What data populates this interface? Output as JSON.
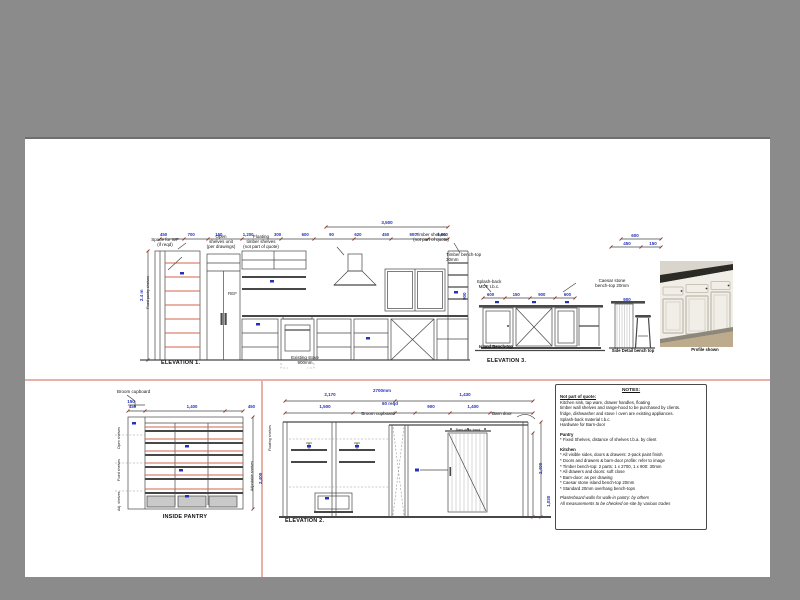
{
  "colors": {
    "background": "#8b8b8b",
    "paper": "#ffffff",
    "dim_blue": "#2633b8",
    "line_dark": "#474747",
    "shelf_red": "#d0664e",
    "divider_pink": "#e8b1a7"
  },
  "elevation1": {
    "title": "ELEVATION 1.",
    "overall_dim": "3,500",
    "top_dims": [
      "450",
      "700",
      "150",
      "1,200",
      "300",
      "600",
      "90",
      "620",
      "450",
      "900",
      "1,000"
    ],
    "left_height_dim": "2.4 m",
    "left_rotated_label": "Fixed pantry shelves",
    "right_height_dim": "900",
    "label_space_wf": "Space for WF\n(if reqd)",
    "label_open_shelves": "Open\nshelves unit\n(per drawings)",
    "label_floating_shelves": "Floating\ntimber shelves\n(not part of quote)",
    "label_timber_shelves": "Timber shelves\n(not part of quote)",
    "label_bench_top": "Timber bench-top\n30mm",
    "fridge_text": "REF",
    "label_stove": "Existing stove\n900mm"
  },
  "elevation3": {
    "title": "ELEVATION 3.",
    "label_splashback": "Splash-back\nMDF t.b.c.",
    "label_caesar": "Caesar stone\nbench-top 20mm",
    "dims": [
      "600",
      "150",
      "900",
      "600"
    ],
    "cab_left_text": "DW",
    "cab_right_text": "Bin",
    "label_island": "Island Bench-top",
    "label_side_detail": "Side Detail bench top",
    "stool_dim": "900"
  },
  "detail_dims": {
    "top": "600",
    "left": "450",
    "right": "150"
  },
  "photo_caption": "Profile shown",
  "pantry": {
    "title": "INSIDE PANTRY",
    "label_broom": "Broom cupboard",
    "dim_small": "150",
    "top_dims": [
      "450",
      "1,400",
      "450"
    ],
    "left_labels": [
      "Open shelves",
      "Fixed shelves",
      "Adj. shelves"
    ],
    "right_label": "Adjustable shelves",
    "right_dim": "2,400"
  },
  "elevation2": {
    "title": "ELEVATION 2.",
    "dim_row1_left": "2,170",
    "dim_row1_center": "2700mm",
    "dim_row1_right": "1,430",
    "dim_row2": [
      "1,500",
      "900",
      "1,400"
    ],
    "dim_gap": "60 reqd",
    "label_broom": "Broom cupboard",
    "label_barn": "Barn door",
    "label_track": "Barn-door track",
    "label_floating": "Floating shelves",
    "right_dims": [
      "2,400",
      "1,030"
    ]
  },
  "notes": {
    "lines": [
      {
        "t": "NOTES:",
        "c": "nb-title"
      },
      {
        "t": "Not part of quote:",
        "c": "nb-bold nb-underline"
      },
      {
        "t": "Kitchen sink, tap ware, drawer handles, floating",
        "c": ""
      },
      {
        "t": "timber wall shelves and range-hood to be purchased by clients.",
        "c": ""
      },
      {
        "t": "fridge, dishwasher and stove / oven are existing appliances.",
        "c": ""
      },
      {
        "t": "Splash-back material t.b.c.",
        "c": ""
      },
      {
        "t": "Hardware for Barn-door",
        "c": ""
      },
      {
        "t": "",
        "c": "nb-gap"
      },
      {
        "t": "Pantry",
        "c": "nb-bold"
      },
      {
        "t": "* Fixed Shelves, distance of shelves t.b.a. by client",
        "c": ""
      },
      {
        "t": "",
        "c": "nb-gap"
      },
      {
        "t": "Kitchen",
        "c": "nb-bold"
      },
      {
        "t": "* All visible sides, doors & drawers: 2-pack paint finish",
        "c": ""
      },
      {
        "t": "* Doors and drawers & barn-door profile: refer to image",
        "c": ""
      },
      {
        "t": "* Timber bench-top: 2 parts: 1 x 2700, 1 x 900: 30mm",
        "c": ""
      },
      {
        "t": "* All drawers and doors: soft close",
        "c": ""
      },
      {
        "t": "* Barn-door: as per drawing",
        "c": ""
      },
      {
        "t": "* Caesar stone island bench-top 20mm",
        "c": ""
      },
      {
        "t": "* Standard 20mm overhang bench-tops",
        "c": ""
      },
      {
        "t": "",
        "c": "nb-gap"
      },
      {
        "t": "Plasterboard walls for walk-in pantry: by others",
        "c": "nb-italic"
      },
      {
        "t": "All measurements to be checked on-site by various trades",
        "c": "nb-italic"
      }
    ]
  }
}
